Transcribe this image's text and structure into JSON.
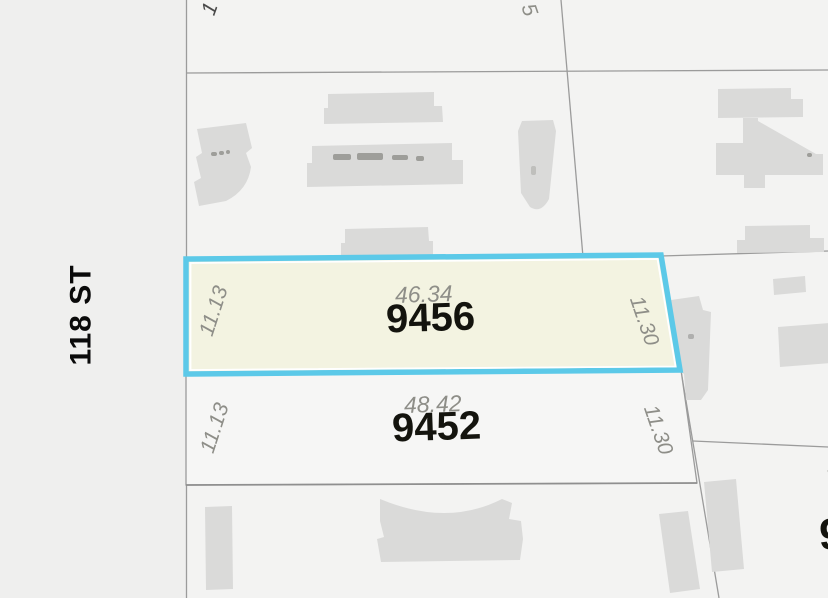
{
  "street": {
    "label": "118 ST"
  },
  "parcels": {
    "selected": {
      "number": "9456",
      "front": "46.34",
      "side_left": "11.13",
      "side_right": "11.30"
    },
    "south": {
      "number": "9452",
      "front": "48.42",
      "side_left": "11.13",
      "side_right": "11.30"
    }
  },
  "partial_labels": {
    "top_left_dim": "1",
    "top_right_dim": "5",
    "right_edge_dim": "1",
    "right_edge_parcel": "9"
  },
  "colors": {
    "selection_border": "#5cc9e8",
    "selection_inner_line": "#ffffff",
    "selection_fill": "#f3f3e1",
    "street_bg": "#efefee",
    "land_bg": "#f3f3f2",
    "parcel_south_fill": "#f6f6f5",
    "building": "#dadad9",
    "boundary_line": "#9b9b9b",
    "boundary_line_strong": "#8f8f8f",
    "dimension_text": "#8e8e88",
    "number_text": "#14140e",
    "street_text": "#0a0a0a",
    "partial_dark_text": "#4a4a4a"
  }
}
